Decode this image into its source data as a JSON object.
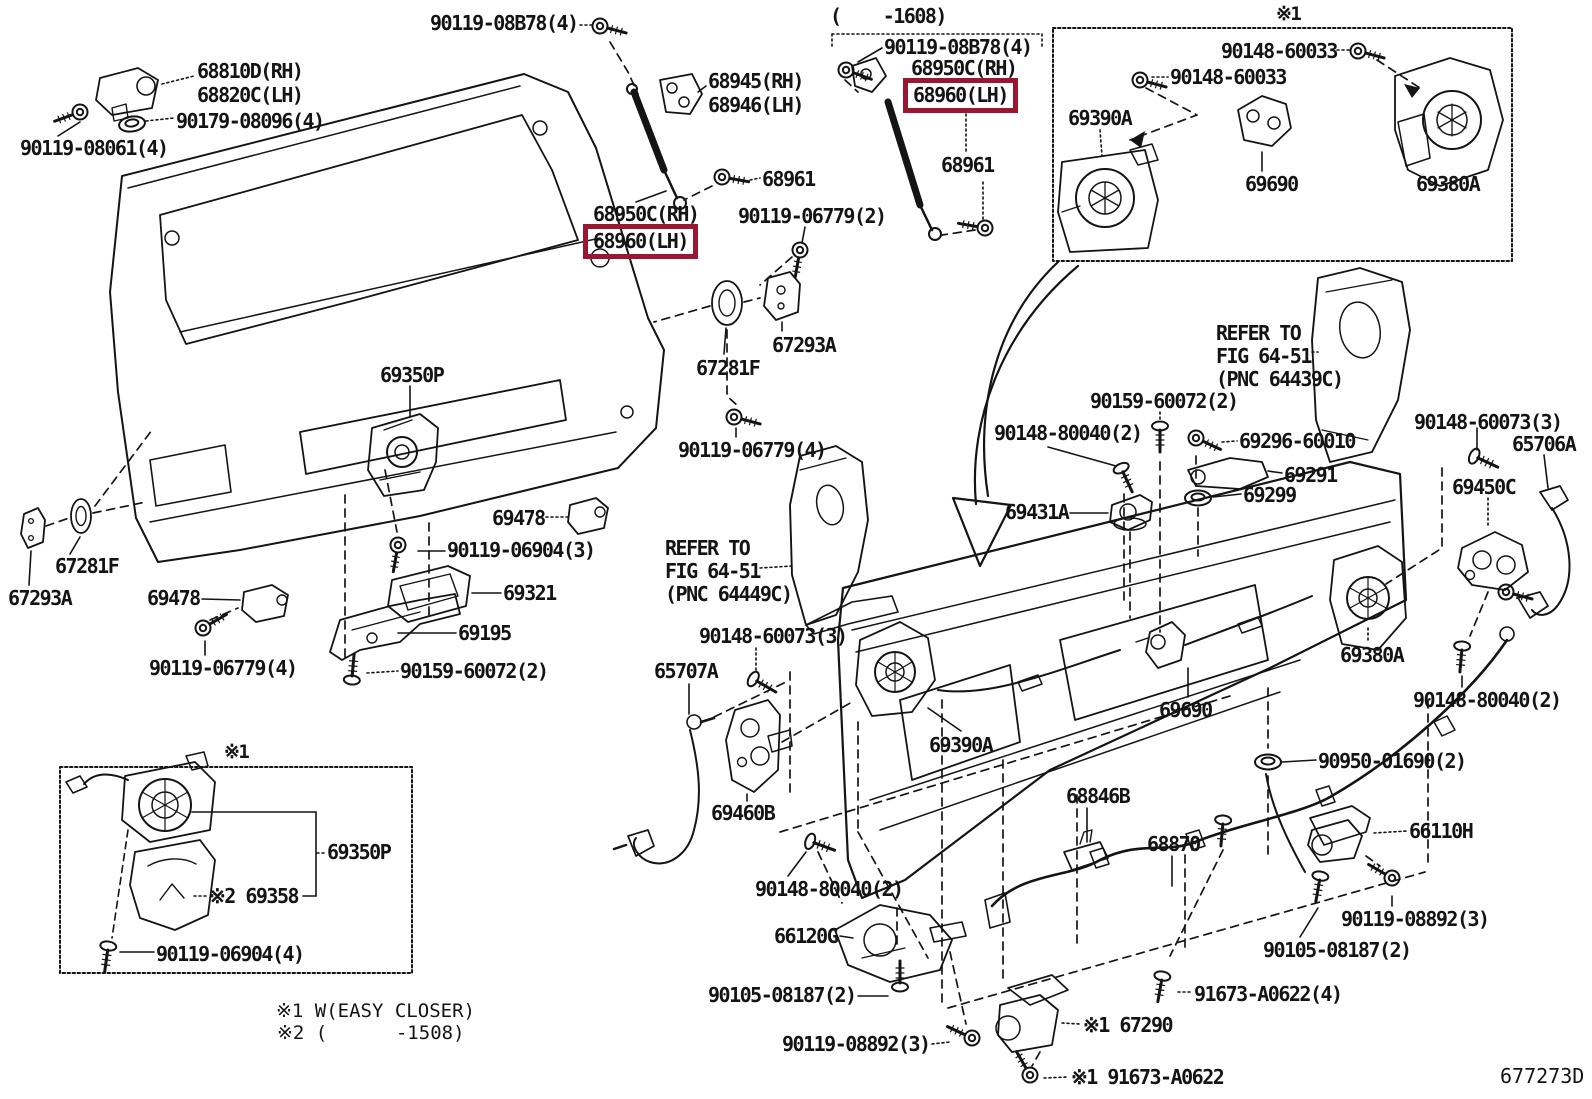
{
  "diagram": {
    "code": "677273D",
    "highlight_color": "#9a1731",
    "range_bracket": "(    -1608)",
    "marker_box_top": "※1",
    "marker_box_bottom": "※1"
  },
  "notes": {
    "n1": "※1 W(EASY CLOSER)",
    "n2": "※2 (      -1508)"
  },
  "refs": {
    "left1": "REFER TO",
    "left2": "FIG 64-51",
    "left3": "(PNC 64449C)",
    "right1": "REFER TO",
    "right2": "FIG 64-51",
    "right3": "(PNC 64439C)"
  },
  "labels": {
    "p08b78_a": "90119-08B78(4)",
    "p68810d": "68810D(RH)",
    "p68820c": "68820C(LH)",
    "p90179": "90179-08096(4)",
    "p08061": "90119-08061(4)",
    "p68945": "68945(RH)",
    "p68946": "68946(LH)",
    "p68961_a": "68961",
    "p68950c_a": "68950C(RH)",
    "p68960_a": "68960(LH)",
    "p08b78_b": "90119-08B78(4)",
    "p68950c_b": "68950C(RH)",
    "p68960_b": "68960(LH)",
    "p68961_b": "68961",
    "p60033_a": "90148-60033",
    "p60033_b": "90148-60033",
    "p69390a_t": "69390A",
    "p69690_t": "69690",
    "p69380a_t": "69380A",
    "p06779_2": "90119-06779(2)",
    "p67293a_r": "67293A",
    "p67281f_r": "67281F",
    "p06779_4r": "90119-06779(4)",
    "p69350p": "69350P",
    "p69478_r": "69478",
    "p06904_3": "90119-06904(3)",
    "p69321": "69321",
    "p69195": "69195",
    "p60072_l": "90159-60072(2)",
    "p69478_l": "69478",
    "p06779_4l": "90119-06779(4)",
    "p67281f_l": "67281F",
    "p67293a_l": "67293A",
    "p60073_l": "90148-60073(3)",
    "p65707a": "65707A",
    "p69460b": "69460B",
    "p69390a_b": "69390A",
    "p60072_c": "90159-60072(2)",
    "p80040_c": "90148-80040(2)",
    "p69296": "69296-60010",
    "p69291": "69291",
    "p69299": "69299",
    "p69431a": "69431A",
    "p60073_r": "90148-60073(3)",
    "p65706a": "65706A",
    "p69450c": "69450C",
    "p80040_r": "90148-80040(2)",
    "p69380a_b": "69380A",
    "p69690_b": "69690",
    "p90950": "90950-01690(2)",
    "p66110h": "66110H",
    "p68846b": "68846B",
    "p68870": "68870",
    "p66120g": "66120G",
    "p80040_cl": "90148-80040(2)",
    "p08187_l": "90105-08187(2)",
    "p08892_l": "90119-08892(3)",
    "p67290": "※1 67290",
    "p91673_b": "※1 91673-A0622",
    "p08892_r": "90119-08892(3)",
    "p08187_r": "90105-08187(2)",
    "p91673_a": "91673-A0622(4)",
    "p69350p_b": "69350P",
    "p69358": "※2 69358",
    "p06904_4": "90119-06904(4)"
  }
}
